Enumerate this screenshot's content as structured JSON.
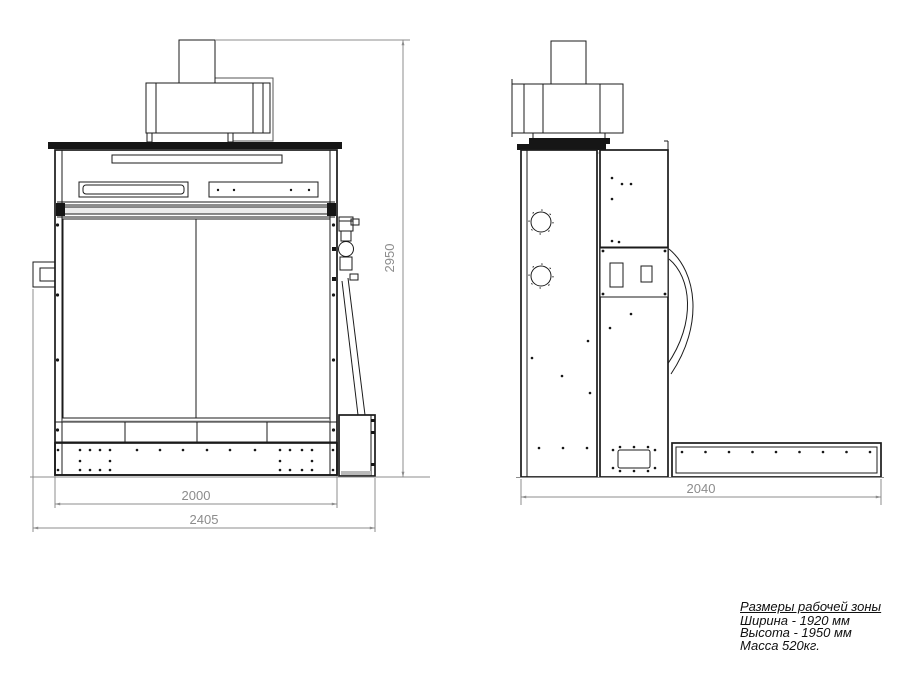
{
  "dimensions": {
    "front_inner_width": "2000",
    "front_total_width": "2405",
    "front_height": "2950",
    "side_depth": "2040"
  },
  "notes": {
    "title": "Размеры рабочей зоны",
    "width_line": "Ширина - 1920 мм",
    "height_line": "Высота - 1950 мм",
    "mass_line": "Масса 520кг."
  },
  "colors": {
    "line": "#1b1b1b",
    "dimension": "#8c8c8c",
    "background": "#ffffff"
  }
}
